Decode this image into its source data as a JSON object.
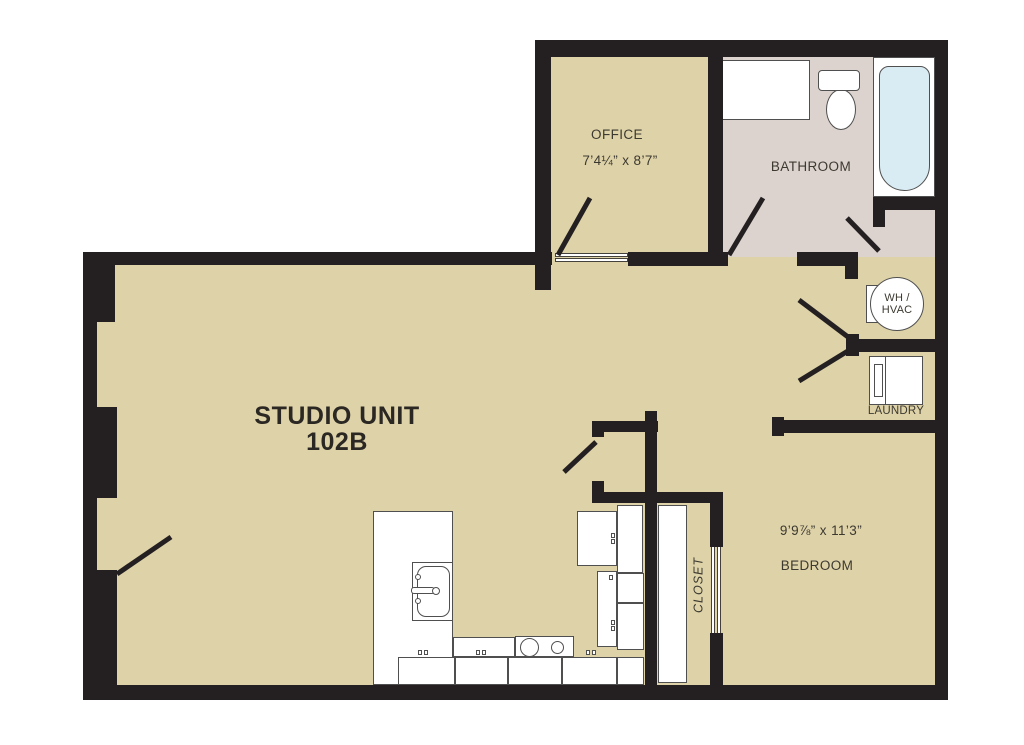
{
  "title": {
    "line1": "STUDIO UNIT",
    "line2": "102B"
  },
  "rooms": {
    "office": {
      "label": "OFFICE",
      "dims": "7’4¼” x 8’7”"
    },
    "bathroom": {
      "label": "BATHROOM"
    },
    "bedroom": {
      "label": "BEDROOM",
      "dims": "9’9⅞” x 11’3”"
    },
    "closet": {
      "label": "CLOSET"
    },
    "laundry": {
      "label": "LAUNDRY"
    },
    "utility": {
      "line1": "WH /",
      "line2": "HVAC"
    }
  },
  "colors": {
    "wall": "#242021",
    "floor": "#ded2a8",
    "bathroom_floor": "#dcd3ce",
    "tub_fill": "#d9ebf3",
    "fixture_stroke": "#4f4f4f",
    "label_text": "#3c3930",
    "title_text": "#2b2823"
  }
}
